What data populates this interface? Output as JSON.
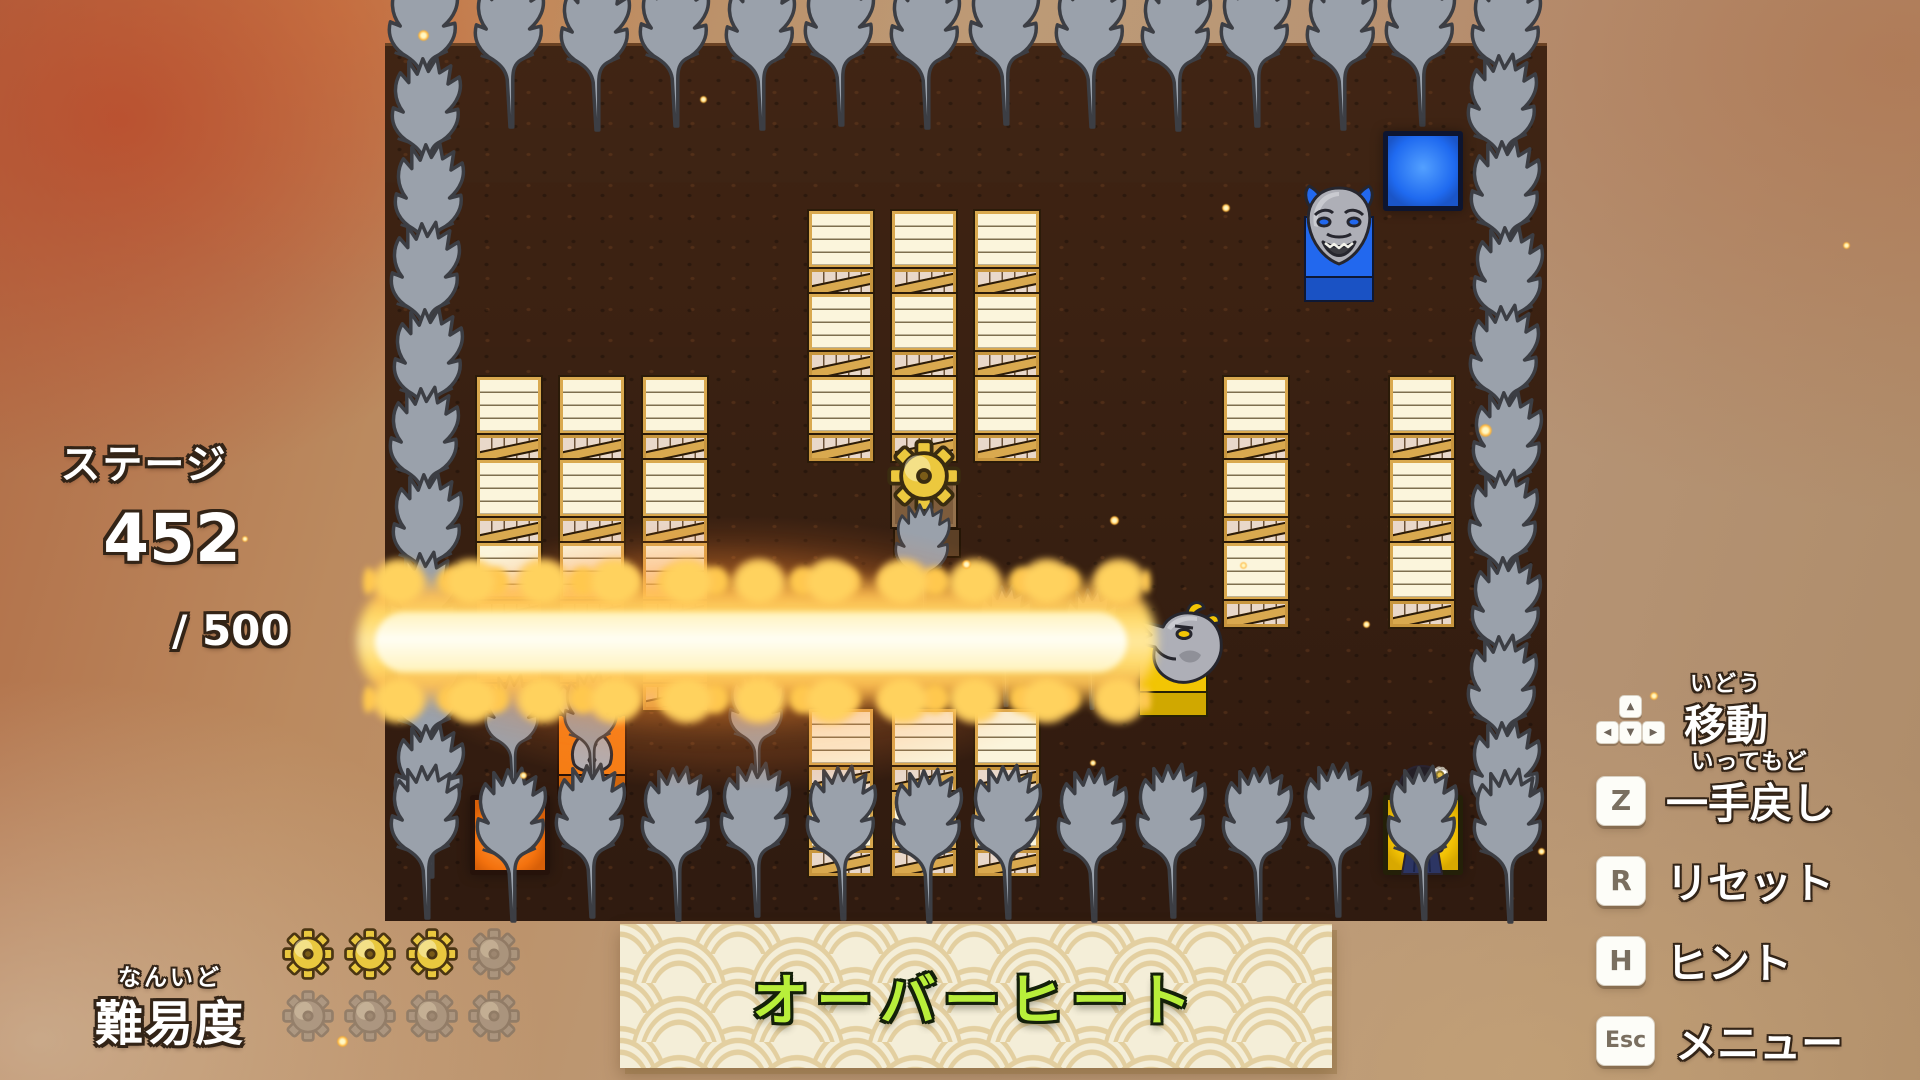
{
  "hud": {
    "stage_label": "ステージ",
    "stage_number": "452",
    "stage_total": "/ 500",
    "difficulty_furigana": "なんいど",
    "difficulty_label": "難易度",
    "difficulty_filled": 3,
    "difficulty_total": 8,
    "banner_title": "オーバーヒート"
  },
  "controls": [
    {
      "key": "arrows",
      "arrows": [
        "▲",
        "◀",
        "▼",
        "▶"
      ],
      "furigana": "いどう",
      "label": "移動"
    },
    {
      "key": "Z",
      "furigana": "いってもど",
      "label": "一手戻し"
    },
    {
      "key": "R",
      "furigana": "",
      "label": "リセット"
    },
    {
      "key": "H",
      "furigana": "",
      "label": "ヒント"
    },
    {
      "key": "Esc",
      "furigana": "",
      "label": "メニュー"
    }
  ],
  "colors": {
    "blue": "#2268ee",
    "orange": "#f57d14",
    "yellow": "#f2c504",
    "gear_gold": "#e9c83f",
    "gear_gray": "#9c948a",
    "tree_gray": "#9aa1ab",
    "crate_frame": "#d9a94f",
    "title_green": "#b8ef3a",
    "banner_cream": "#f4eed8",
    "dirt_brown": "#3a2113"
  },
  "board": {
    "origin": [
      385,
      43
    ],
    "cell": 83,
    "cols": 14,
    "rows": 11,
    "border_trees": {
      "top_row_cols": [
        0,
        1,
        2,
        3,
        4,
        5,
        6,
        7,
        8,
        9,
        10,
        11,
        12,
        13
      ],
      "left_col_rows": [
        1,
        2,
        3,
        4,
        5,
        6,
        7,
        8,
        9,
        10
      ],
      "right_col_rows": [
        1,
        2,
        3,
        4,
        5,
        6,
        7,
        8,
        9,
        10
      ],
      "bottom_row_cols": [
        1,
        2,
        3,
        4,
        5,
        6,
        7,
        8,
        9,
        10,
        11,
        12
      ]
    },
    "interior_trees": [
      [
        1,
        8
      ],
      [
        2,
        8
      ],
      [
        4,
        8
      ],
      [
        6,
        6
      ],
      [
        7,
        7
      ],
      [
        8,
        7
      ]
    ],
    "crates": [
      [
        5,
        2
      ],
      [
        6,
        2
      ],
      [
        7,
        2
      ],
      [
        5,
        3
      ],
      [
        6,
        3
      ],
      [
        7,
        3
      ],
      [
        5,
        4
      ],
      [
        6,
        4
      ],
      [
        7,
        4
      ],
      [
        1,
        4
      ],
      [
        2,
        4
      ],
      [
        3,
        4
      ],
      [
        1,
        5
      ],
      [
        2,
        5
      ],
      [
        3,
        5
      ],
      [
        1,
        6
      ],
      [
        2,
        6
      ],
      [
        3,
        6
      ],
      [
        1,
        7
      ],
      [
        2,
        7
      ],
      [
        3,
        7
      ],
      [
        10,
        4
      ],
      [
        12,
        4
      ],
      [
        10,
        5
      ],
      [
        12,
        5
      ],
      [
        10,
        6
      ],
      [
        12,
        6
      ],
      [
        5,
        8
      ],
      [
        6,
        8
      ],
      [
        7,
        8
      ],
      [
        5,
        9
      ],
      [
        6,
        9
      ],
      [
        7,
        9
      ]
    ],
    "gear_block": [
      6,
      5
    ],
    "goal_tiles": [
      {
        "color": "blue",
        "col": 12,
        "row": 1
      },
      {
        "color": "orange",
        "col": 1,
        "row": 9
      },
      {
        "color": "yellow",
        "col": 12,
        "row": 9
      }
    ],
    "dragon_statues": [
      {
        "color": "blue",
        "col": 11,
        "row": 2,
        "facing": "front"
      },
      {
        "color": "orange",
        "col": 2,
        "row": 8,
        "facing": "back"
      },
      {
        "color": "yellow",
        "col": 9,
        "row": 7,
        "facing": "left",
        "state": "breathing-fire"
      }
    ],
    "player": {
      "col": 12,
      "row": 9
    },
    "fire_beam": {
      "row": 7,
      "from_col": 0,
      "to_col": 9
    }
  },
  "effects": {
    "embers": [
      [
        418,
        30,
        11
      ],
      [
        700,
        96,
        7
      ],
      [
        1222,
        204,
        8
      ],
      [
        1479,
        424,
        13
      ],
      [
        1110,
        516,
        9
      ],
      [
        1240,
        562,
        7
      ],
      [
        1650,
        692,
        8
      ],
      [
        1363,
        621,
        7
      ],
      [
        520,
        772,
        7
      ],
      [
        1763,
        962,
        9
      ],
      [
        337,
        1036,
        11
      ],
      [
        1538,
        848,
        7
      ],
      [
        242,
        536,
        6
      ],
      [
        1843,
        242,
        7
      ],
      [
        962,
        560,
        9
      ],
      [
        1090,
        760,
        6
      ]
    ]
  }
}
